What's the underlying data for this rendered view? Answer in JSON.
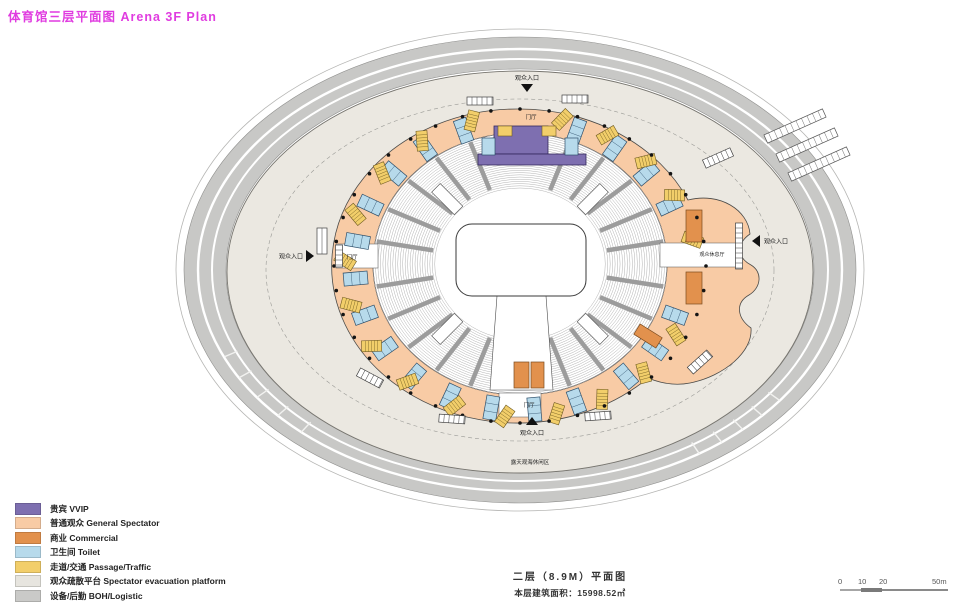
{
  "title": {
    "text": "体育馆三层平面图 Arena 3F Plan",
    "color": "#E03CE0"
  },
  "plan": {
    "entrances": {
      "top": "观众入口",
      "bottom": "观众入口",
      "left": "观众入口",
      "right": "观众入口"
    },
    "foyers": {
      "top": "门厅",
      "left": "门厅",
      "bottom": "门厅"
    },
    "lounge": "观众休息厅",
    "leisure_area": "露天观海休闲区"
  },
  "legend": {
    "items": [
      {
        "label": "贵宾 VVIP",
        "color": "#7E6FB0"
      },
      {
        "label": "普通观众 General Spectator",
        "color": "#F8CBA5"
      },
      {
        "label": "商业 Commercial",
        "color": "#E2914D"
      },
      {
        "label": "卫生间 Toilet",
        "color": "#B7DAEB"
      },
      {
        "label": "走道/交通 Passage/Traffic",
        "color": "#F2CE6A"
      },
      {
        "label": "观众疏散平台 Spectator evacuation platform",
        "color": "#E7E5DF"
      },
      {
        "label": "设备/后勤 BOH/Logistic",
        "color": "#CACAC8"
      }
    ]
  },
  "caption": {
    "line1": "二层（8.9M）平面图",
    "line2": "本层建筑面积：15998.52㎡"
  },
  "scalebar": {
    "ticks": [
      "0",
      "10",
      "20",
      "50m"
    ]
  },
  "colors": {
    "road": "#C8C8C6",
    "platform": "#EBE8E1",
    "court": "#FFFFFF"
  }
}
